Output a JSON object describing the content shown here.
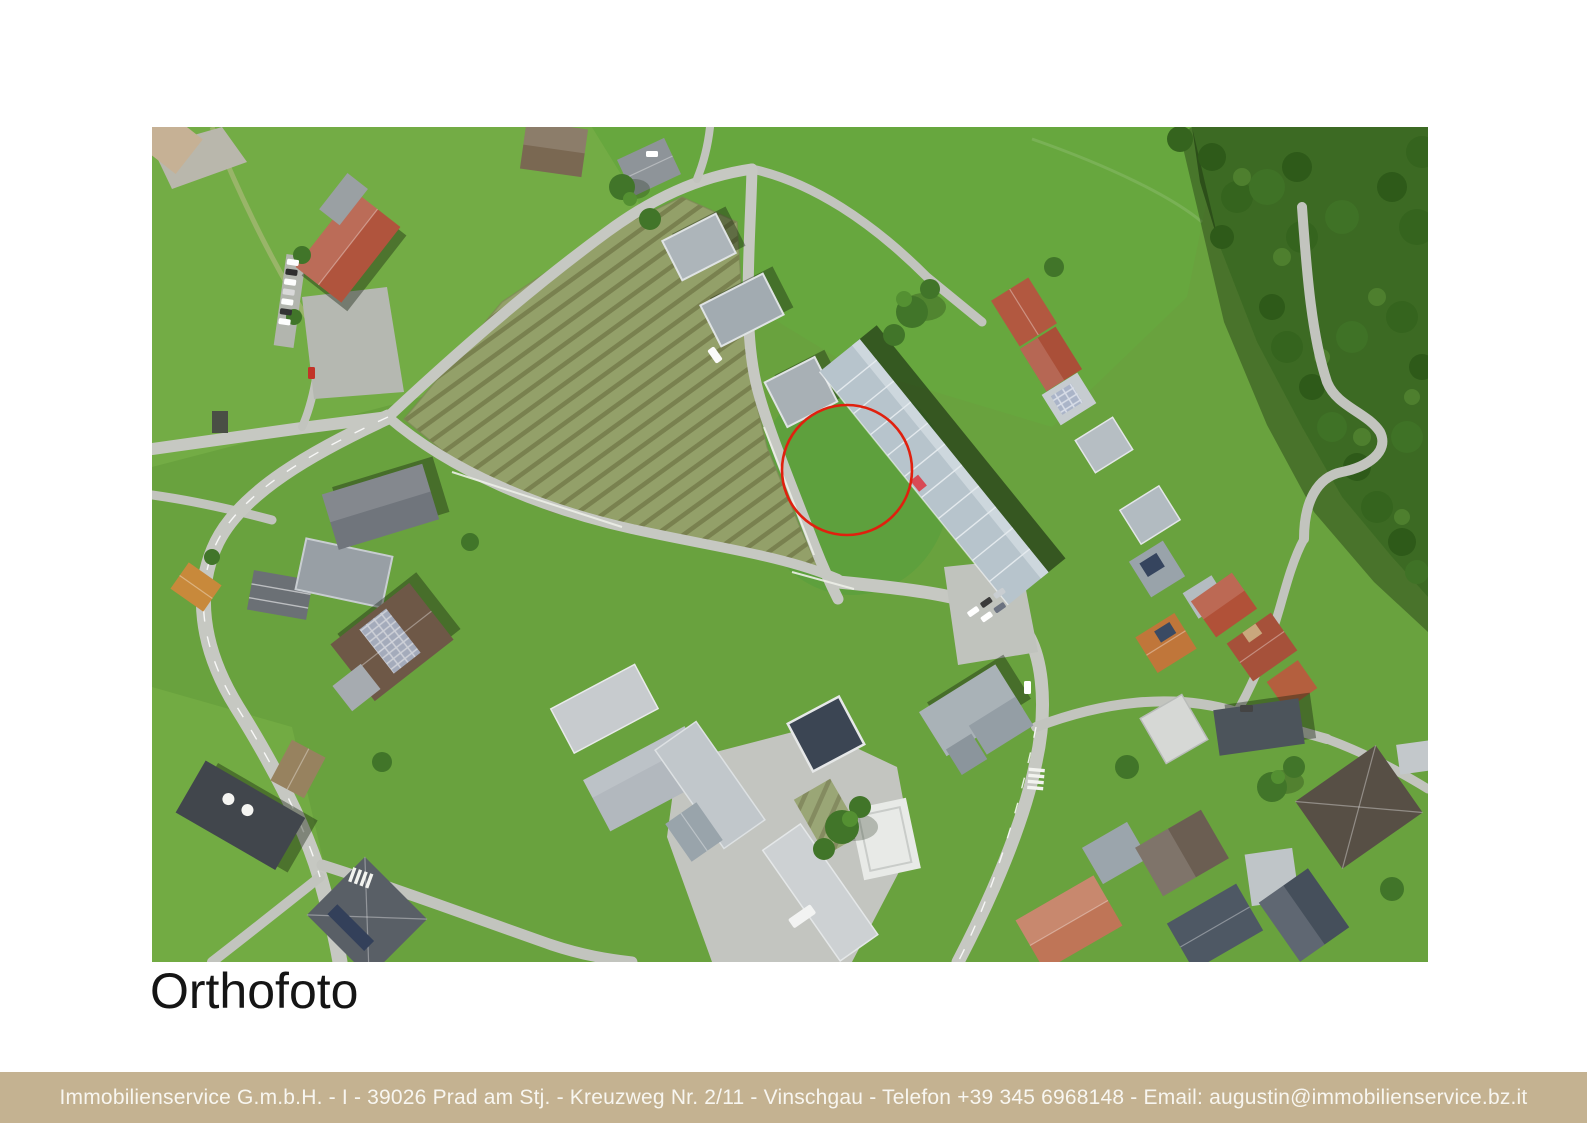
{
  "document": {
    "title": "Orthofoto"
  },
  "map": {
    "kind": "aerial orthophoto of a village with fields, terraced houses, roads and forest",
    "marker": {
      "shape": "circle",
      "label": "highlighted building plot",
      "color": "#e0200e"
    }
  },
  "footer": {
    "text": "Immobilienservice G.m.b.H. - I - 39026 Prad am Stj. - Kreuzweg Nr. 2/11 - Vinschgau - Telefon +39 345 6968148 - Email: augustin@immobilienservice.bz.it",
    "background_color": "#c4b291",
    "text_color": "#f8f6f0"
  }
}
